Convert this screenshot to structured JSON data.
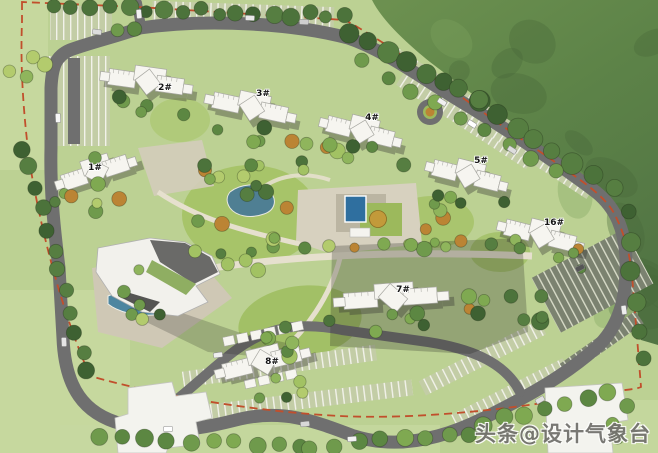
{
  "watermark": {
    "text": "头条@设计气象台",
    "color": "#73726e"
  },
  "buildings": [
    {
      "label": "1#",
      "x": 97,
      "y": 172,
      "label_dx": -2,
      "label_dy": -2,
      "rot": -18,
      "sx": 0.95
    },
    {
      "label": "2#",
      "x": 148,
      "y": 82,
      "label_dx": 17,
      "label_dy": 8,
      "rot": 8,
      "sx": 1.05
    },
    {
      "label": "3#",
      "x": 252,
      "y": 108,
      "label_dx": 11,
      "label_dy": -12,
      "rot": 12,
      "sx": 1.05
    },
    {
      "label": "4#",
      "x": 362,
      "y": 132,
      "label_dx": 10,
      "label_dy": -12,
      "rot": 14,
      "sx": 0.95
    },
    {
      "label": "5#",
      "x": 468,
      "y": 176,
      "label_dx": 13,
      "label_dy": -13,
      "rot": 14,
      "sx": 0.95
    },
    {
      "label": "16#",
      "x": 542,
      "y": 236,
      "label_dx": 12,
      "label_dy": -11,
      "rot": 14,
      "sx": 1.0
    },
    {
      "label": "7#",
      "x": 393,
      "y": 298,
      "label_dx": 10,
      "label_dy": -6,
      "rot": -4,
      "sx": 1.3
    },
    {
      "label": "8#",
      "x": 264,
      "y": 362,
      "label_dx": 8,
      "label_dy": 2,
      "rot": -14,
      "sx": 1.1
    }
  ],
  "colors": {
    "lawn": "#bcd193",
    "lawn_light": "#c6d8a0",
    "lawn_bright": "#a4c265",
    "hill_top": "#6d9150",
    "hill_mid": "#5d8348",
    "hill_dark": "#49683a",
    "hill_light": "#7fa25e",
    "road": "#6f6f6f",
    "paving": "#d7d1bf",
    "deck": "#b8b19e",
    "building": "#f6f5f0",
    "massing": "#f3f3ee",
    "shadow": "#3a3a36",
    "water": "#2f6f9f",
    "pond": "#4f7f93",
    "pool_club": "#4d86a0",
    "green_roof": "#8fae62",
    "boundary": "#c14f2c",
    "stall_bg": "#c3cda6",
    "stall_line": "#f2f2ea",
    "stall_bg_dark": "#7b8270",
    "stall_line_dark": "#d8dbc8",
    "trees_dark": [
      "#3e6132",
      "#4c733b",
      "#567e41"
    ],
    "trees_mid": [
      "#5c8742",
      "#6f9a4c",
      "#7fa951"
    ],
    "trees_light": [
      "#8fb55c",
      "#a2c263",
      "#b3cb6d"
    ],
    "accent_tree": "#bb8434",
    "feature_tree": "#c29a3a"
  }
}
